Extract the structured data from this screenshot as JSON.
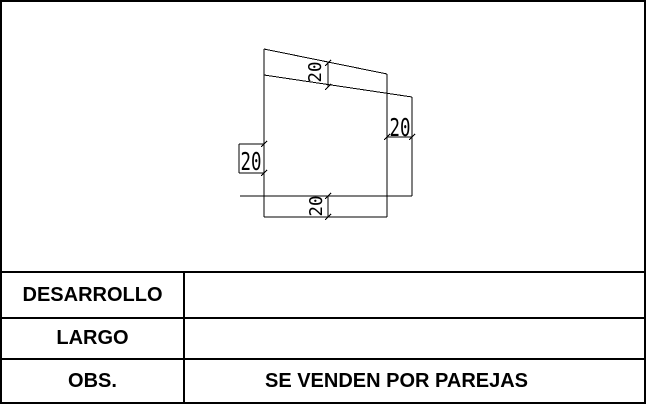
{
  "sheet": {
    "background_color": "#ffffff",
    "line_color": "#000000",
    "text_color": "#000000"
  },
  "drawing": {
    "description": "sheet-metal development outline with dimension annotations",
    "dimensions": {
      "top": "20",
      "right": "20",
      "left": "20",
      "bottom": "20"
    }
  },
  "table": {
    "rows": [
      {
        "label": "DESARROLLO",
        "value": ""
      },
      {
        "label": "LARGO",
        "value": ""
      },
      {
        "label": "OBS.",
        "value": "SE VENDEN POR PAREJAS"
      }
    ]
  }
}
